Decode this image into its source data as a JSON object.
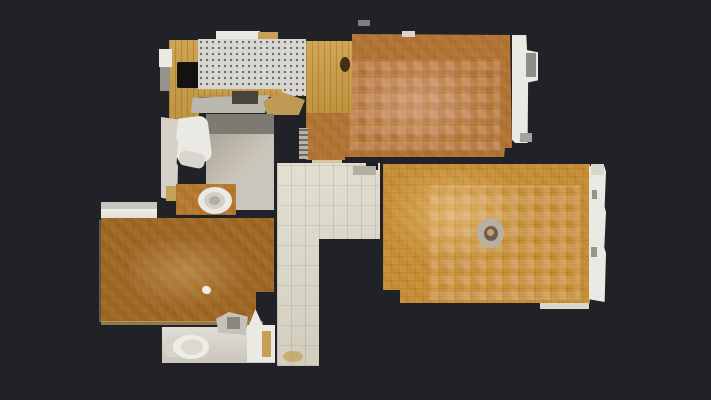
{
  "canvas": {
    "width": 711,
    "height": 400,
    "background": "#212227"
  },
  "palette": {
    "background": "#212227",
    "parquet_livingroom": "#b27231",
    "parquet_bedroom_right": "#c58c33",
    "parquet_bedroom_left": "#9d6522",
    "parquet_wc_nook": "#b5772c",
    "oak_cabinet": "#c79a41",
    "oak_panel": "#ca9c42",
    "kitchen_tile": "#d8d7d2",
    "hall_tile": "#ddd9ca",
    "bath_tile": "#c0b9ac",
    "fixture_white": "#ebe9e3",
    "soft_white": "#d9d6cd",
    "tan": "#c5a055"
  },
  "floorplan": {
    "regions": [
      {
        "name": "kitchen-cabinet-band",
        "x": 169,
        "y": 40,
        "w": 30,
        "h": 92,
        "fill": "#c79a41",
        "cls": "vgrain",
        "it": false
      },
      {
        "name": "kitchen-stove",
        "x": 177,
        "y": 62,
        "w": 22,
        "h": 26,
        "fill": "#151110",
        "r": "2px",
        "it": false
      },
      {
        "name": "kitchen-top-white-sliver",
        "x": 216,
        "y": 31,
        "w": 44,
        "h": 10,
        "fill": "#ebe9e3",
        "it": false
      },
      {
        "name": "kitchen-top-tan-sliver",
        "x": 258,
        "y": 32,
        "w": 20,
        "h": 8,
        "fill": "#c5a055",
        "it": false
      },
      {
        "name": "kitchen-tile-floor",
        "x": 198,
        "y": 39,
        "w": 108,
        "h": 57,
        "cls": "tile-dots",
        "it": true
      },
      {
        "name": "kitchen-counter-strip",
        "x": 198,
        "y": 89,
        "w": 84,
        "h": 8,
        "fill": "#c79a41",
        "cls": "vgrain",
        "it": false
      },
      {
        "name": "livingroom-floor",
        "x": 306,
        "y": 31,
        "w": 212,
        "h": 131,
        "fill": "#b27231",
        "cls": "parquet",
        "it": true,
        "clip": "polygon(0px 10px, 46px 10px, 46px 3px, 204px 4px, 206px 117px, 199px 117px, 198px 126px, 39px 126px, 39px 129px, 0px 129px)"
      },
      {
        "name": "livingroom-floor-sheen",
        "x": 340,
        "y": 55,
        "w": 150,
        "h": 95,
        "cls": "glow-pink",
        "it": false
      },
      {
        "name": "livingroom-floor-checker",
        "x": 350,
        "y": 60,
        "w": 150,
        "h": 90,
        "cls": "checker",
        "op": 0.8,
        "it": false
      },
      {
        "name": "livingroom-window-sill",
        "x": 512,
        "y": 35,
        "w": 26,
        "h": 108,
        "fill": "#ebe9e3",
        "it": false,
        "clip": "polygon(0 0, 55% 0, 58% 14%, 100% 16%, 100% 42%, 62% 44%, 60% 100%, 12% 100%, 0 97%)"
      },
      {
        "name": "livingroom-window-mark-1",
        "x": 526,
        "y": 53,
        "w": 10,
        "h": 24,
        "fill": "#8f8d88",
        "it": false
      },
      {
        "name": "livingroom-window-mark-2",
        "x": 520,
        "y": 133,
        "w": 12,
        "h": 9,
        "fill": "#a5a29c",
        "it": false
      },
      {
        "name": "livingroom-top-notch",
        "x": 402,
        "y": 31,
        "w": 13,
        "h": 6,
        "fill": "#d9d6cd",
        "it": false
      },
      {
        "name": "livingroom-door-threshold",
        "x": 312,
        "y": 160,
        "w": 30,
        "h": 6,
        "fill": "#d7c5a0",
        "it": false
      },
      {
        "name": "kitchen-wood-door-panel",
        "x": 306,
        "y": 41,
        "w": 46,
        "h": 72,
        "fill": "#ca9c42",
        "cls": "vgrain",
        "it": false
      },
      {
        "name": "kitchen-panel-knot",
        "x": 340,
        "y": 57,
        "w": 10,
        "h": 15,
        "fill": "rgba(45,28,10,0.85)",
        "r": "50%",
        "it": false
      },
      {
        "name": "kitchen-table",
        "x": 191,
        "y": 95,
        "w": 78,
        "h": 18,
        "fill": "#bab7af",
        "it": false,
        "clip": "polygon(2% 15%, 100% 0%, 95% 100%, 0% 100%)"
      },
      {
        "name": "kitchen-appliance-dark",
        "x": 232,
        "y": 91,
        "w": 26,
        "h": 13,
        "fill": "#49433e",
        "it": false
      },
      {
        "name": "kitchen-tan-shape",
        "x": 263,
        "y": 92,
        "w": 42,
        "h": 23,
        "fill": "#c09a55",
        "it": false,
        "clip": "polygon(0 40%, 45% 0, 100% 35%, 85% 100%, 10% 100%)"
      },
      {
        "name": "kitchen-left-white-bit",
        "x": 159,
        "y": 49,
        "w": 13,
        "h": 18,
        "fill": "#ebe9e3",
        "it": false
      },
      {
        "name": "kitchen-left-gray-bit",
        "x": 160,
        "y": 67,
        "w": 10,
        "h": 24,
        "fill": "#96938c",
        "it": false
      },
      {
        "name": "ladder-object",
        "x": 299,
        "y": 128,
        "w": 9,
        "h": 31,
        "cls": "ladder",
        "it": false
      },
      {
        "name": "wall-speck",
        "x": 358,
        "y": 20,
        "w": 12,
        "h": 6,
        "fill": "rgba(220,215,205,0.5)",
        "it": false
      },
      {
        "name": "bedroom-right-floor",
        "x": 383,
        "y": 164,
        "w": 207,
        "h": 141,
        "fill": "#c58c33",
        "cls": "parquet",
        "it": true,
        "clip": "polygon(0px 0px, 207px 0px, 207px 139px, 17px 139px, 17px 126px, 0px 126px)"
      },
      {
        "name": "bedroom-right-sheen",
        "x": 390,
        "y": 170,
        "w": 140,
        "h": 95,
        "cls": "glow-warm",
        "it": false
      },
      {
        "name": "bedroom-right-checker",
        "x": 430,
        "y": 185,
        "w": 150,
        "h": 115,
        "cls": "checker",
        "op": 0.85,
        "it": false
      },
      {
        "name": "bedroom-right-window-sill",
        "x": 589,
        "y": 166,
        "w": 17,
        "h": 136,
        "fill": "#ebe9e3",
        "it": false,
        "clip": "polygon(0 0, 90% 0, 100% 4%, 92% 30%, 100% 34%, 90% 60%, 100% 64%, 92% 100%, 0 98%)"
      },
      {
        "name": "bedroom-right-window-mark-1",
        "x": 592,
        "y": 190,
        "w": 5,
        "h": 9,
        "fill": "#96938c",
        "it": false
      },
      {
        "name": "bedroom-right-window-mark-2",
        "x": 591,
        "y": 247,
        "w": 6,
        "h": 10,
        "fill": "#96938c",
        "it": false
      },
      {
        "name": "bedroom-right-bottom-strip",
        "x": 540,
        "y": 303,
        "w": 49,
        "h": 6,
        "fill": "#d9d6cd",
        "it": false
      },
      {
        "name": "bedroom-right-corner-white",
        "x": 591,
        "y": 164,
        "w": 13,
        "h": 11,
        "fill": "#d9d6cd",
        "it": false
      },
      {
        "name": "ceiling-lamp-outer",
        "x": 477,
        "y": 218,
        "w": 27,
        "h": 30,
        "fill": "#b7b0a4",
        "r": "50%",
        "it": false
      },
      {
        "name": "ceiling-lamp-inner",
        "x": 484,
        "y": 226,
        "w": 14,
        "h": 15,
        "fill": "#6d5e4c",
        "r": "50%",
        "it": false
      },
      {
        "name": "ceiling-lamp-dot",
        "x": 487,
        "y": 229,
        "w": 7,
        "h": 7,
        "fill": "#caa06a",
        "r": "50%",
        "it": false
      },
      {
        "name": "hallway-floor",
        "x": 277,
        "y": 163,
        "w": 103,
        "h": 203,
        "fill": "#ddd9ca",
        "cls": "hall-tiles",
        "it": true,
        "clip": "polygon(0px 0px, 103px 0px, 103px 76px, 42px 76px, 42px 203px, 0px 203px)"
      },
      {
        "name": "hallway-wall-stub",
        "x": 366,
        "y": 163,
        "w": 12,
        "h": 7,
        "fill": "#1b1c1f",
        "it": false
      },
      {
        "name": "hallway-doormat",
        "x": 353,
        "y": 166,
        "w": 23,
        "h": 9,
        "fill": "#b3aea2",
        "it": false
      },
      {
        "name": "hallway-floor-stain",
        "x": 283,
        "y": 351,
        "w": 20,
        "h": 11,
        "fill": "rgba(193,152,61,0.6)",
        "r": "50%",
        "it": false
      },
      {
        "name": "bathroom-floor",
        "x": 206,
        "y": 114,
        "w": 68,
        "h": 96,
        "fill": "#c0b9ac",
        "cls": "bath-grad",
        "it": true
      },
      {
        "name": "bathroom-dark-band",
        "x": 206,
        "y": 114,
        "w": 68,
        "h": 20,
        "fill": "#7e7971",
        "it": false
      },
      {
        "name": "bathtub",
        "x": 175,
        "y": 117,
        "w": 35,
        "h": 46,
        "fill": "#ebe9e3",
        "r": "9px",
        "rot": -7,
        "it": false
      },
      {
        "name": "bathtub-ledge",
        "x": 179,
        "y": 152,
        "w": 26,
        "h": 15,
        "fill": "#d9d6cd",
        "r": "6px",
        "rot": 12,
        "it": false
      },
      {
        "name": "bathroom-left-column",
        "x": 161,
        "y": 117,
        "w": 17,
        "h": 84,
        "fill": "#d5d1c8",
        "it": false,
        "clip": "polygon(0 0, 100% 3%, 88% 25%, 100% 28%, 92% 55%, 100% 58%, 95% 100%, 0 96%)"
      },
      {
        "name": "bathroom-left-tan-bit",
        "x": 166,
        "y": 186,
        "w": 12,
        "h": 15,
        "fill": "#c5a055",
        "it": false
      },
      {
        "name": "wc-nook-floor",
        "x": 176,
        "y": 184,
        "w": 60,
        "h": 31,
        "fill": "#b5772c",
        "cls": "parquet",
        "it": true
      },
      {
        "name": "wc-nook-toilet",
        "x": 198,
        "y": 187,
        "w": 34,
        "h": 27,
        "fill": "#ebe9e3",
        "r": "50%",
        "it": false
      },
      {
        "name": "wc-nook-toilet-seat",
        "x": 204,
        "y": 192,
        "w": 21,
        "h": 17,
        "fill": "#d3cfc6",
        "r": "50%",
        "it": false
      },
      {
        "name": "wc-nook-toilet-bowl",
        "x": 209,
        "y": 196,
        "w": 11,
        "h": 9,
        "fill": "#b3aea3",
        "r": "50%",
        "it": false
      },
      {
        "name": "radiator-top-band",
        "x": 101,
        "y": 202,
        "w": 56,
        "h": 7,
        "fill": "#c7c5bf",
        "it": false
      },
      {
        "name": "radiator-block",
        "x": 101,
        "y": 209,
        "w": 56,
        "h": 13,
        "fill": "#ebe9e3",
        "cls": "soft-grad",
        "it": false
      },
      {
        "name": "bedroom-left-edge-line",
        "x": 99,
        "y": 220,
        "w": 4,
        "h": 102,
        "fill": "rgba(190,170,130,0.4)",
        "it": false
      },
      {
        "name": "bedroom-left-floor",
        "x": 101,
        "y": 218,
        "w": 173,
        "h": 104,
        "fill": "#9d6522",
        "cls": "parquet",
        "it": true,
        "clip": "polygon(0px 0px, 173px 0px, 173px 74px, 155px 74px, 155px 104px, 0px 104px)"
      },
      {
        "name": "bedroom-left-sheen",
        "x": 130,
        "y": 240,
        "w": 120,
        "h": 70,
        "cls": "glow-warm",
        "op": 0.7,
        "it": false
      },
      {
        "name": "bedroom-left-speck",
        "x": 202,
        "y": 286,
        "w": 9,
        "h": 8,
        "fill": "#f2ecdc",
        "r": "50%",
        "rot": 20,
        "it": false
      },
      {
        "name": "bedroom-left-baseboard",
        "x": 101,
        "y": 321,
        "w": 162,
        "h": 4,
        "fill": "rgba(202,167,101,0.65)",
        "it": false
      },
      {
        "name": "wc-bottom-floor",
        "x": 162,
        "y": 327,
        "w": 113,
        "h": 36,
        "fill": "#d6d2c9",
        "cls": "soft-grad",
        "it": true
      },
      {
        "name": "wc-bottom-right-white",
        "x": 247,
        "y": 325,
        "w": 28,
        "h": 37,
        "fill": "#ebe9e3",
        "it": false
      },
      {
        "name": "wc-bottom-tan-strip",
        "x": 262,
        "y": 331,
        "w": 9,
        "h": 26,
        "fill": "#c5a055",
        "it": false
      },
      {
        "name": "wc-bottom-toilet-tank",
        "x": 166,
        "y": 337,
        "w": 11,
        "h": 20,
        "fill": "#d7d3ca",
        "it": false
      },
      {
        "name": "wc-bottom-toilet",
        "x": 173,
        "y": 335,
        "w": 36,
        "h": 24,
        "fill": "#efede8",
        "r": "50%",
        "it": false
      },
      {
        "name": "wc-bottom-toilet-seat",
        "x": 181,
        "y": 339,
        "w": 22,
        "h": 16,
        "fill": "#ddd9d0",
        "r": "50%",
        "it": false
      },
      {
        "name": "wc-bottom-sink",
        "x": 216,
        "y": 312,
        "w": 32,
        "h": 23,
        "fill": "#c6c2b9",
        "it": false,
        "clip": "polygon(0 30%, 40% 0, 100% 20%, 92% 100%, 8% 90%)"
      },
      {
        "name": "wc-bottom-sink-dark",
        "x": 227,
        "y": 317,
        "w": 13,
        "h": 12,
        "fill": "#8b877f",
        "it": false
      },
      {
        "name": "wc-bottom-white-wedge",
        "x": 247,
        "y": 309,
        "w": 17,
        "h": 21,
        "fill": "#ebe9e3",
        "it": false,
        "clip": "polygon(0 100%, 50% 0, 100% 90%)"
      }
    ]
  }
}
